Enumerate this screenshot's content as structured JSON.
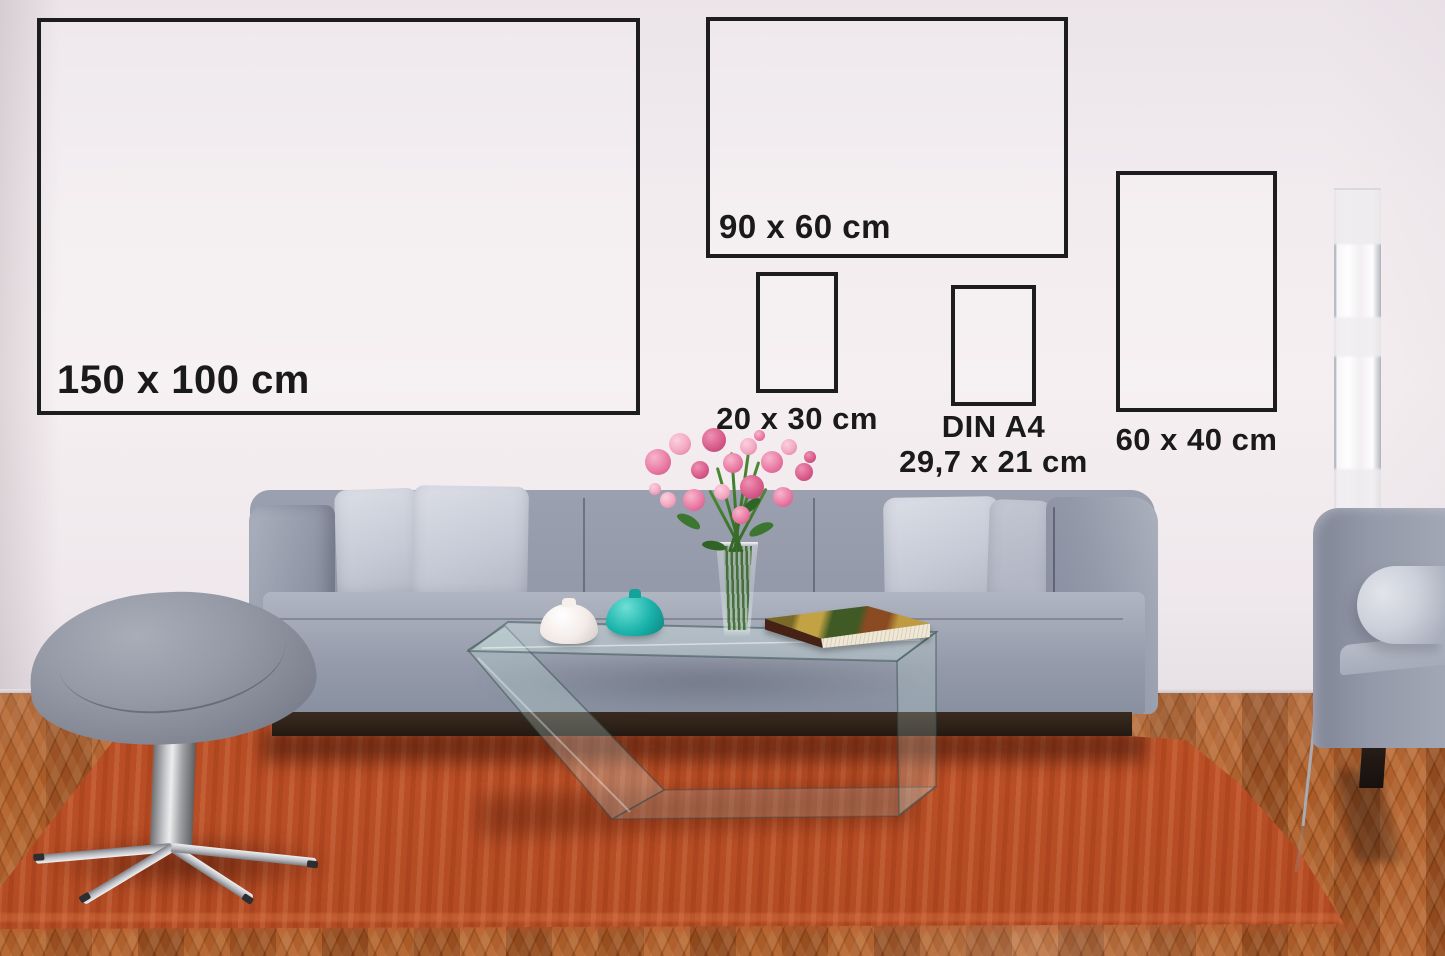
{
  "frames": [
    {
      "name": "frame-150x100",
      "label": "150 x 100 cm"
    },
    {
      "name": "frame-90x60",
      "label": "90 x 60 cm"
    },
    {
      "name": "frame-20x30",
      "label": "20 x 30 cm"
    },
    {
      "name": "frame-din-a4",
      "label_line1": "DIN A4",
      "label_line2": "29,7 x 21 cm"
    },
    {
      "name": "frame-60x40",
      "label": "60 x 40 cm"
    }
  ],
  "colors": {
    "wall": "#f1ebee",
    "frame_border": "#1d1d1f",
    "label_text": "#1a1a1a",
    "rug": "#bb4f26",
    "wood_floor": "#a0521f",
    "sofa_fabric": "#969cab",
    "pillow_fabric": "#ccd0da",
    "teal_vase": "#19b2aa",
    "white_vase": "#f3ebe8",
    "flower_pink": "#e87ba2",
    "stem_green": "#3f7b2f",
    "lamp_white": "#fbfafb",
    "book_pages": "#e9e1cf"
  }
}
